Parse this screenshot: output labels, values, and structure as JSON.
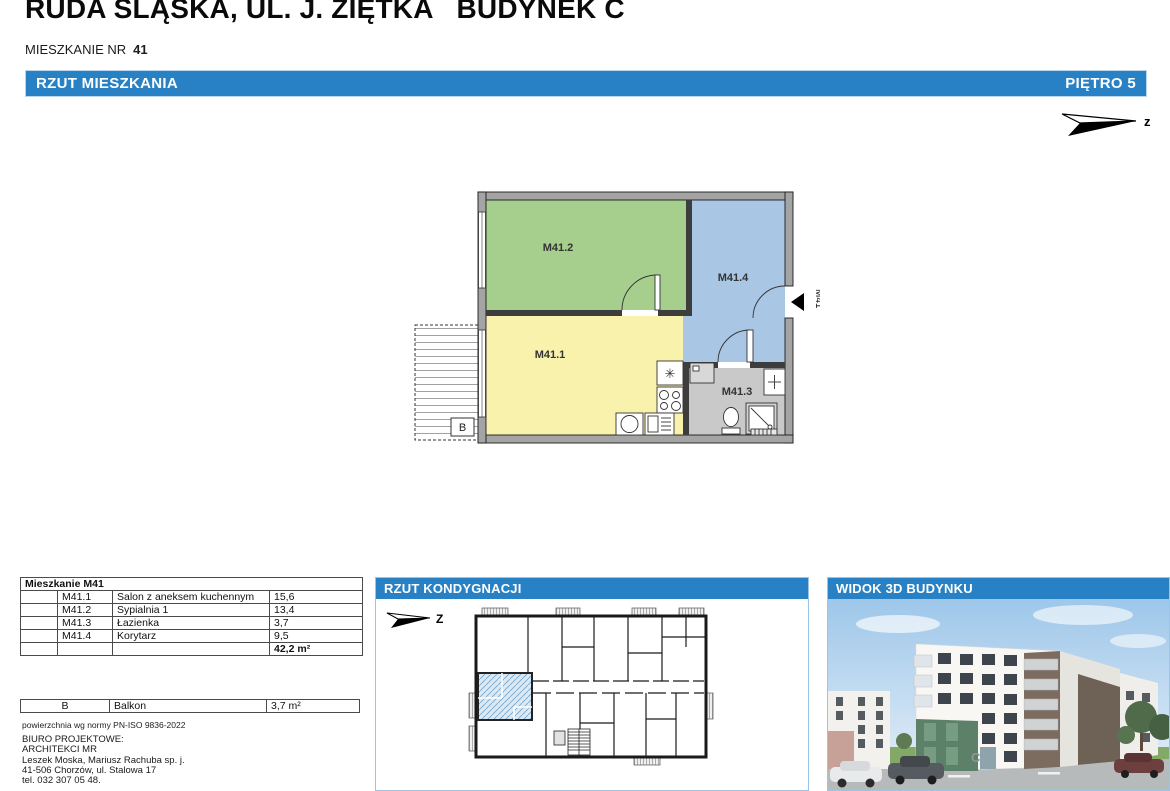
{
  "page": {
    "title": "RUDA ŚLĄSKA, UL. J. ZIĘTKA   BUDYNEK C",
    "apartment_label": "MIESZKANIE NR",
    "apartment_number": "41"
  },
  "main_bar": {
    "left": "RZUT MIESZKANIA",
    "right": "PIĘTRO 5"
  },
  "north_arrow": {
    "main_label": "z",
    "panel_label": "Z"
  },
  "plan": {
    "room_labels": {
      "living": "M41.1",
      "bedroom": "M41.2",
      "bathroom": "M41.3",
      "corridor": "M41.4"
    },
    "balcony_label": "B",
    "entry_label": "M41",
    "room_colors": {
      "living": "#f8f2ad",
      "bedroom": "#a6cf8e",
      "corridor": "#a9c6e4",
      "bathroom": "#c9c9c9"
    }
  },
  "area_table": {
    "header": "Mieszkanie M41",
    "rows": [
      {
        "code": "M41.1",
        "name": "Salon z aneksem kuchennym",
        "area": "15,6"
      },
      {
        "code": "M41.2",
        "name": "Sypialnia 1",
        "area": "13,4"
      },
      {
        "code": "M41.3",
        "name": "Łazienka",
        "area": "3,7"
      },
      {
        "code": "M41.4",
        "name": "Korytarz",
        "area": "9,5"
      }
    ],
    "total": "42,2 m²"
  },
  "balcony_table": {
    "code": "B",
    "name": "Balkon",
    "area": "3,7 m²"
  },
  "norm_note": "powierzchnia wg normy PN-ISO 9836-2022",
  "office": {
    "lines": [
      "BIURO PROJEKTOWE:",
      "ARCHITEKCI MR",
      "Leszek Moska, Mariusz Rachuba sp. j.",
      "41-506 Chorzów, ul. Stalowa 17",
      "tel. 032 307 05 48."
    ]
  },
  "floor_panel": {
    "title": "RZUT KONDYGNACJI"
  },
  "view3d_panel": {
    "title": "WIDOK 3D BUDYNKU",
    "building_letter": "C"
  },
  "colors": {
    "accent_blue": "#2781c4",
    "panel_border": "#9dc3e6",
    "hatch_blue": "#79a8cc"
  }
}
